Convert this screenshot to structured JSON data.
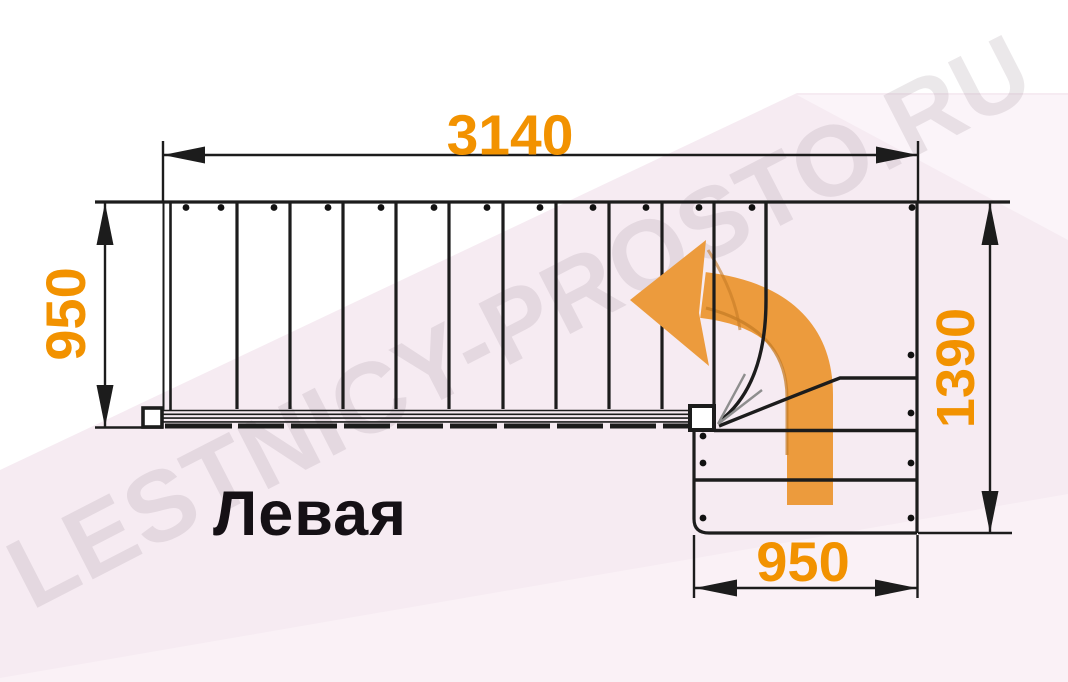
{
  "diagram": {
    "title_label": "Левая",
    "watermark_text": "LESTNICY-PROSTO.RU",
    "dimensions": {
      "total_length_mm": "3140",
      "flight_width_mm": "950",
      "turn_depth_mm": "1390",
      "lower_flight_width_mm": "950"
    },
    "stairs": {
      "straight_tread_count": 10,
      "lower_tread_count": 3,
      "turn_direction": "left-turn-90"
    },
    "colors": {
      "dimension_text": "#F29200",
      "arrow_fill": "#EC9B3D",
      "arrow_shadow": "#C67C26",
      "line_color": "#1C1C1C",
      "background_pink": "#F6EBF2",
      "background_pink_light": "#FBF4F9",
      "watermark_gray": "#E8E4E7"
    }
  }
}
